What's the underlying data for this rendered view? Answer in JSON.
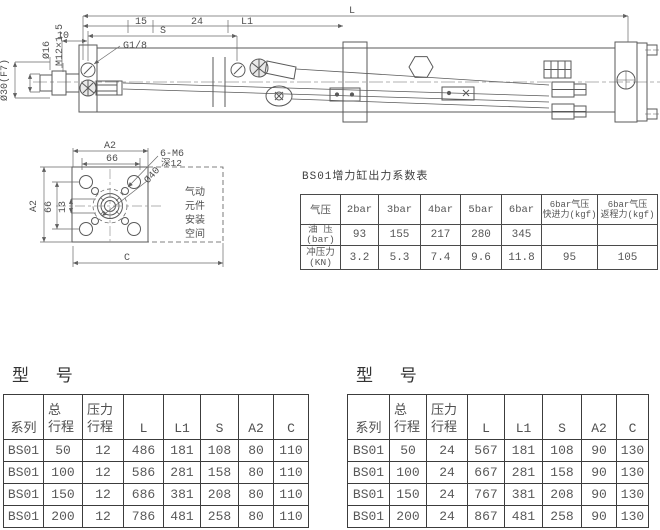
{
  "side_view": {
    "labels": {
      "L": "L",
      "L1": "L1",
      "S": "S",
      "d15": "15",
      "d24": "24",
      "d10": "10",
      "port": "G1/8",
      "rod_dia": "Ø30(F7)",
      "dia16": "Ø16",
      "thread": "M12×1.5"
    }
  },
  "front_view": {
    "labels": {
      "A2_top": "A2",
      "d66_top": "66",
      "holes": "6-M6",
      "depth": "深12",
      "dia40": "Ø40",
      "A2_left": "A2",
      "d66_left": "66",
      "d13": "13",
      "C": "C"
    },
    "space_note": [
      "气动",
      "元件",
      "安装",
      "空间"
    ]
  },
  "force_table": {
    "title": "BS01增力缸出力系数表",
    "col_headers": [
      "气压",
      "2bar",
      "3bar",
      "4bar",
      "5bar",
      "6bar"
    ],
    "col_fast": {
      "line1": "6bar气压",
      "line2": "快进力(kgf)"
    },
    "col_return": {
      "line1": "6bar气压",
      "line2": "返程力(kgf)"
    },
    "rows": [
      {
        "label1": "油 压",
        "label2": "(bar)",
        "v": [
          "93",
          "155",
          "217",
          "280",
          "345",
          "",
          ""
        ]
      },
      {
        "label1": "冲压力",
        "label2": "(KN)",
        "v": [
          "3.2",
          "5.3",
          "7.4",
          "9.6",
          "11.8",
          "95",
          "105"
        ]
      }
    ]
  },
  "model_tables": [
    {
      "title": "型 号",
      "headers": {
        "series": "系列",
        "total1": "总",
        "total2": "行程",
        "press1": "压力",
        "press2": "行程",
        "L": "L",
        "L1": "L1",
        "S": "S",
        "A2": "A2",
        "C": "C"
      },
      "rows": [
        [
          "BS01",
          "50",
          "12",
          "486",
          "181",
          "108",
          "80",
          "110"
        ],
        [
          "BS01",
          "100",
          "12",
          "586",
          "281",
          "158",
          "80",
          "110"
        ],
        [
          "BS01",
          "150",
          "12",
          "686",
          "381",
          "208",
          "80",
          "110"
        ],
        [
          "BS01",
          "200",
          "12",
          "786",
          "481",
          "258",
          "80",
          "110"
        ]
      ]
    },
    {
      "title": "型 号",
      "headers": {
        "series": "系列",
        "total1": "总",
        "total2": "行程",
        "press1": "压力",
        "press2": "行程",
        "L": "L",
        "L1": "L1",
        "S": "S",
        "A2": "A2",
        "C": "C"
      },
      "rows": [
        [
          "BS01",
          "50",
          "24",
          "567",
          "181",
          "108",
          "90",
          "130"
        ],
        [
          "BS01",
          "100",
          "24",
          "667",
          "281",
          "158",
          "90",
          "130"
        ],
        [
          "BS01",
          "150",
          "24",
          "767",
          "381",
          "208",
          "90",
          "130"
        ],
        [
          "BS01",
          "200",
          "24",
          "867",
          "481",
          "258",
          "90",
          "130"
        ]
      ]
    }
  ],
  "colors": {
    "line": "#5a5a5a",
    "dim_line": "#6a6a6a",
    "table_line": "#3c3c3c",
    "text": "#4f4f4f"
  }
}
